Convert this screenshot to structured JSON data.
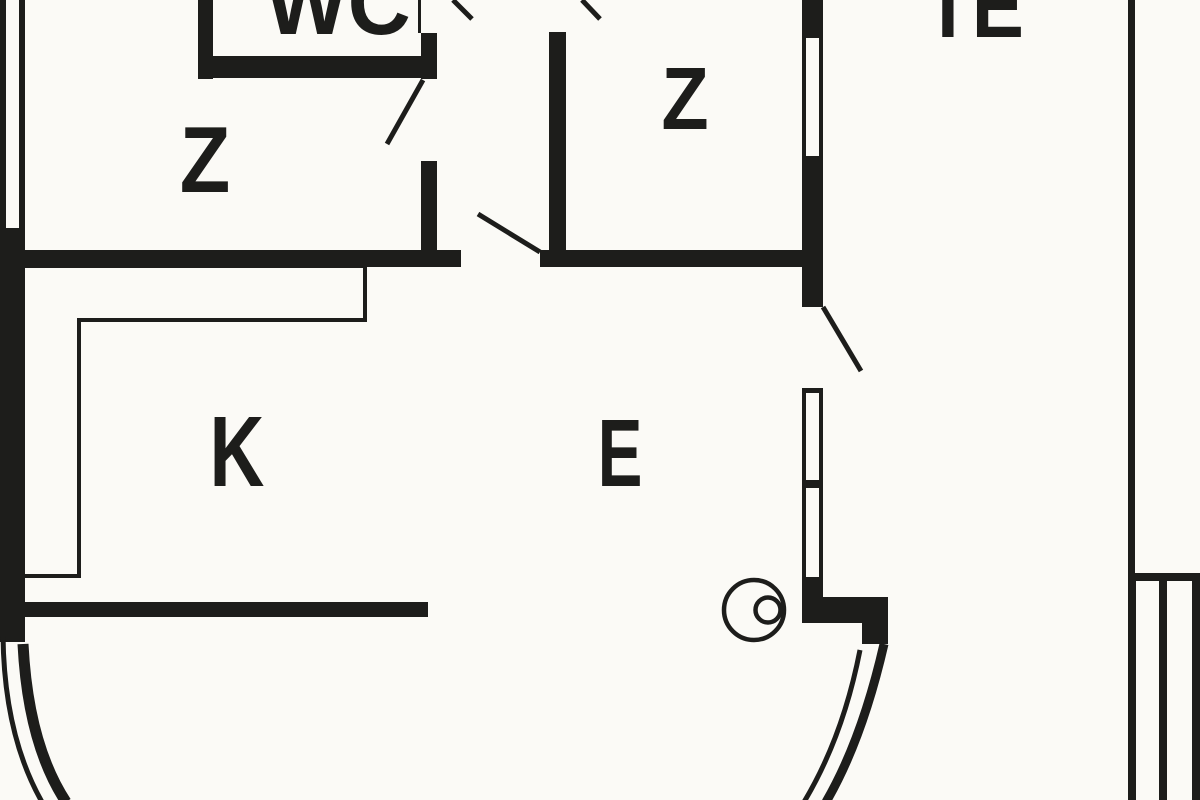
{
  "floorplan": {
    "background_color": "#fbfaf6",
    "wall_color": "#1d1d1b",
    "rooms": [
      {
        "label": "WC"
      },
      {
        "label": "Z"
      },
      {
        "label": "Z"
      },
      {
        "label": "K"
      },
      {
        "label": "E"
      },
      {
        "label": "TE"
      }
    ]
  }
}
